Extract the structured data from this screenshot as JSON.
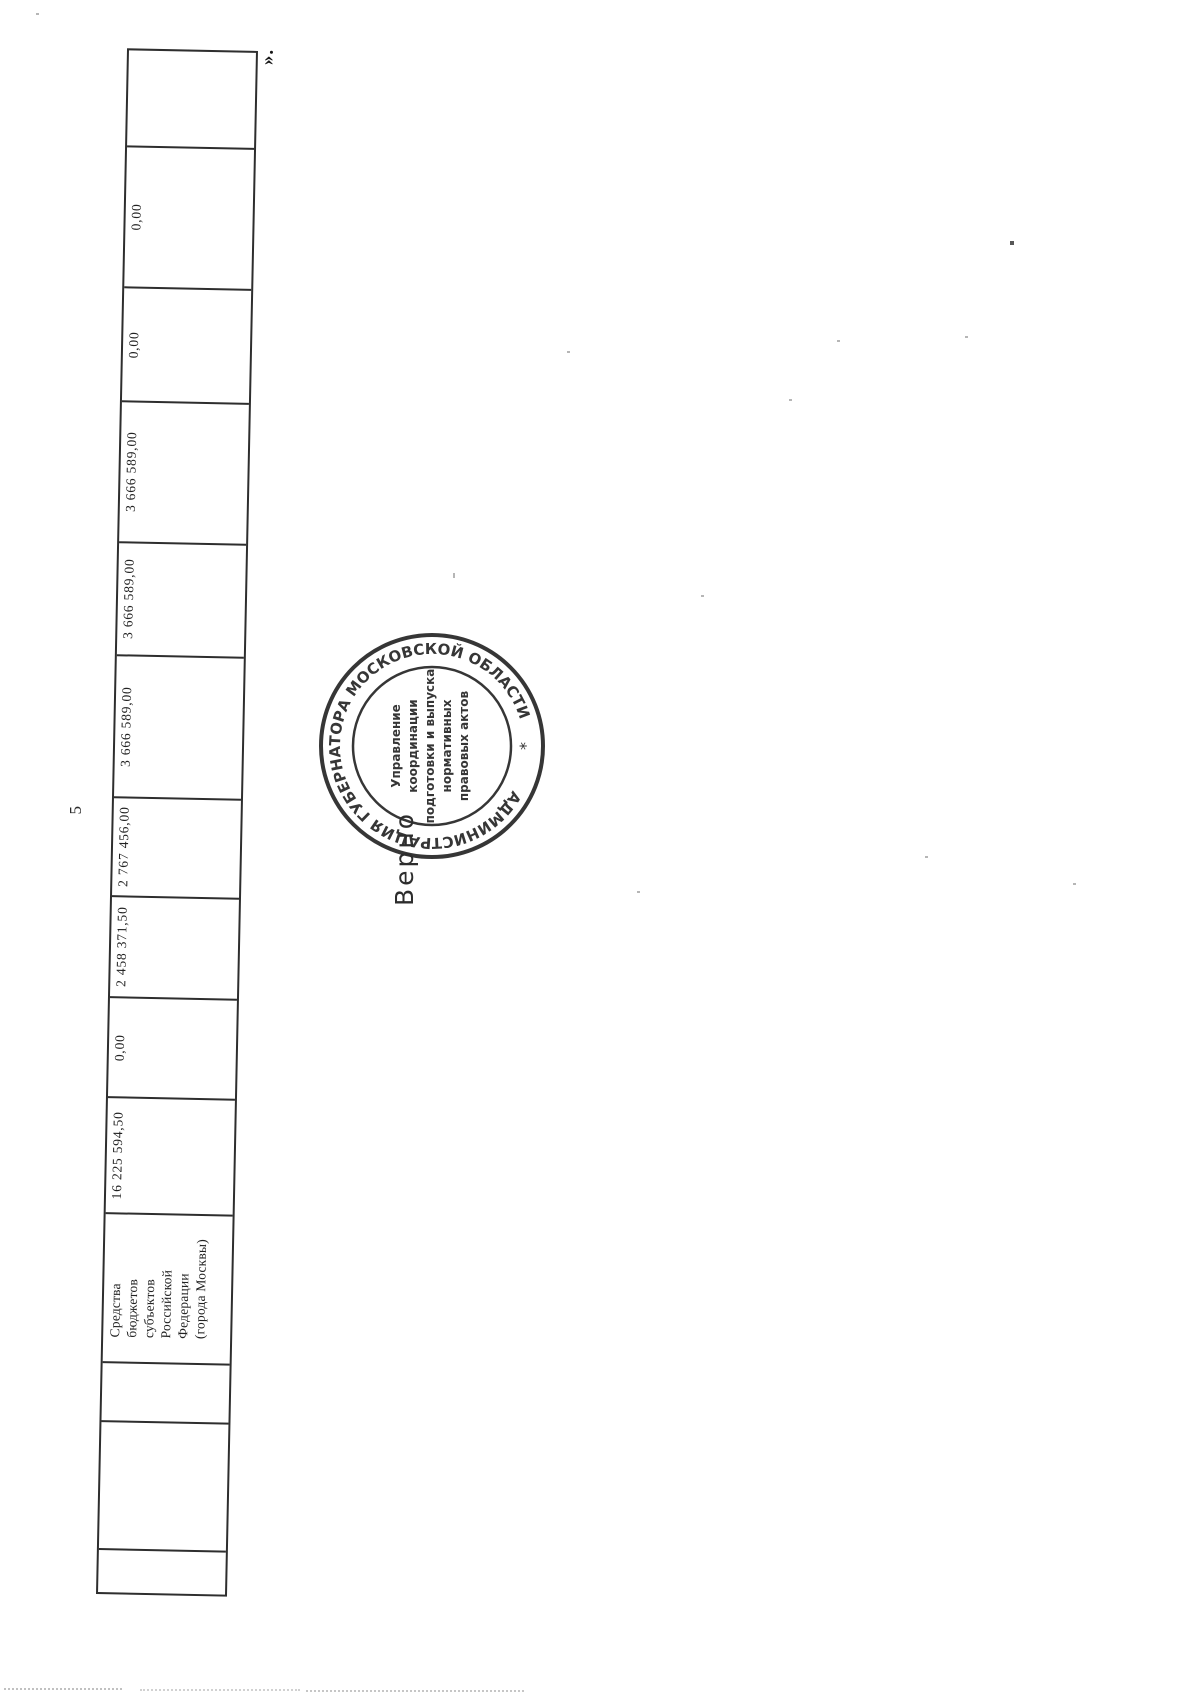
{
  "page": {
    "number": "5",
    "closing_quote_mark": "».",
    "verification_note": "Верно"
  },
  "table": {
    "cells": [
      {
        "value": ""
      },
      {
        "value": "0,00"
      },
      {
        "value": "0,00"
      },
      {
        "value": "3 666 589,00"
      },
      {
        "value": "3 666 589,00"
      },
      {
        "value": "3 666 589,00"
      },
      {
        "value": "2 767 456,00"
      },
      {
        "value": "2 458 371,50"
      },
      {
        "value": "0,00"
      },
      {
        "value": "16 225 594,50"
      },
      {
        "value": "Средства\nбюджетов\nсубъектов\nРоссийской\nФедерации\n(города Москвы)"
      },
      {
        "value": ""
      },
      {
        "value": ""
      },
      {
        "value": ""
      }
    ]
  },
  "stamp": {
    "ring_text": "АДМИНИСТРАЦИЯ ГУБЕРНАТОРА МОСКОВСКОЙ ОБЛАСТИ",
    "separator": "*",
    "center_lines": [
      "Управление",
      "координации",
      "подготовки и выпуска",
      "нормативных",
      "правовых актов"
    ],
    "ink_color": "#262626"
  }
}
